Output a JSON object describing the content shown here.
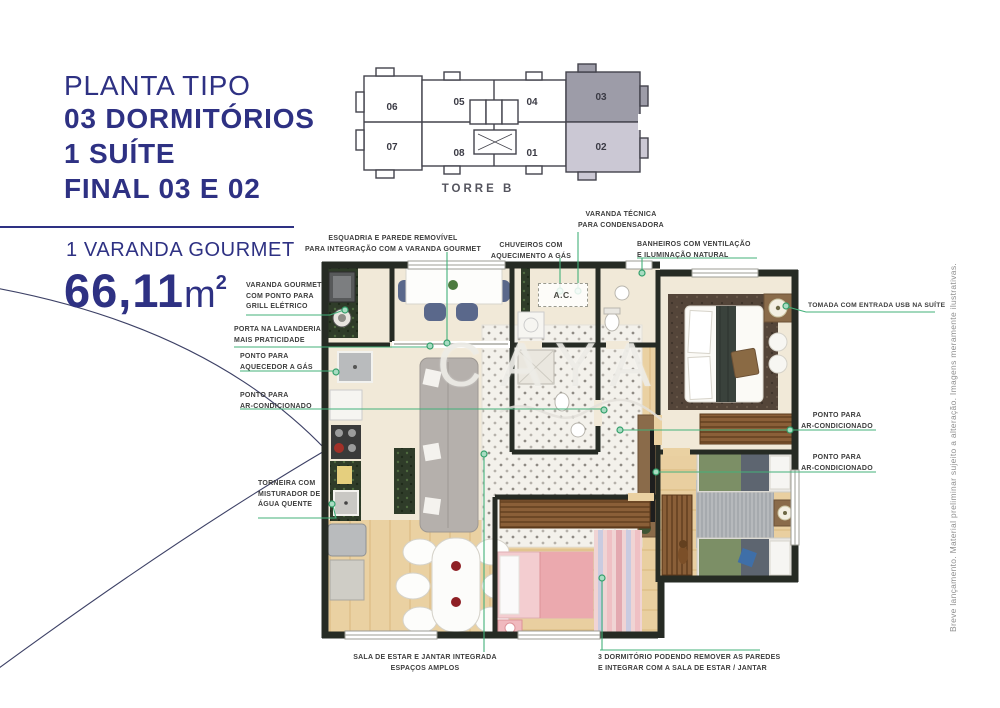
{
  "header": {
    "title_line1": "PLANTA TIPO",
    "title_line2": "03 DORMITÓRIOS",
    "title_line3": "1 SUÍTE",
    "title_line4": "FINAL 03 E 02",
    "subtitle": "1 VARANDA GOURMET",
    "area_value": "66,11",
    "area_unit": "m",
    "area_exponent": "2"
  },
  "tower_diagram": {
    "label": "TORRE B",
    "units": [
      "06",
      "05",
      "04",
      "03",
      "07",
      "08",
      "01",
      "02"
    ],
    "highlighted_units": [
      "03",
      "02"
    ],
    "unit_03_fill": "#9d9ca8",
    "unit_02_fill": "#cbc8d4"
  },
  "floor_plan": {
    "ac_label": "A.C.",
    "watermark": "CAYA"
  },
  "annotations": [
    {
      "id": "esquadria",
      "text": "ESQUADRIA E PAREDE REMOVÍVEL\nPARA INTEGRAÇÃO COM A VARANDA GOURMET"
    },
    {
      "id": "chuveiros",
      "text": "CHUVEIROS COM\nAQUECIMENTO A GÁS"
    },
    {
      "id": "varanda_tecnica",
      "text": "VARANDA TÉCNICA\nPARA CONDENSADORA"
    },
    {
      "id": "banheiros",
      "text": "BANHEIROS COM VENTILAÇÃO\nE ILUMINAÇÃO NATURAL"
    },
    {
      "id": "tomada_usb",
      "text": "TOMADA COM ENTRADA USB NA SUÍTE"
    },
    {
      "id": "ar_condicionado_suite",
      "text": "PONTO PARA\nAR-CONDICIONADO"
    },
    {
      "id": "ar_condicionado_dorm",
      "text": "PONTO PARA\nAR-CONDICIONADO"
    },
    {
      "id": "varanda_gourmet",
      "text": "VARANDA GOURMET\nCOM PONTO PARA\nGRILL ELÉTRICO"
    },
    {
      "id": "porta_lavanderia",
      "text": "PORTA NA LAVANDERIA\nMAIS PRATICIDADE"
    },
    {
      "id": "aquecedor",
      "text": "PONTO PARA\nAQUECEDOR A GÁS"
    },
    {
      "id": "ar_condicionado_sala",
      "text": "PONTO PARA\nAR-CONDICIONADO"
    },
    {
      "id": "torneira",
      "text": "TORNEIRA COM\nMISTURADOR DE\nÁGUA QUENTE"
    },
    {
      "id": "sala_integrada",
      "text": "SALA DE ESTAR E JANTAR INTEGRADA\nESPAÇOS AMPLOS"
    },
    {
      "id": "dormitorio3",
      "text": "3 DORMITÓRIO PODENDO REMOVER AS PAREDES\nE INTEGRAR COM A SALA DE ESTAR / JANTAR"
    }
  ],
  "disclaimer": "Breve lançamento. Material preliminar sujeito a alteração. Imagens meramente ilustrativas.",
  "colors": {
    "accent_indigo": "#2e3183",
    "leader_green": "#43b17a",
    "wall_dark": "#262b24",
    "floor_cream": "#f1e9d8",
    "floor_wood": "#ead1a2",
    "label_text": "#3d3d3d"
  }
}
